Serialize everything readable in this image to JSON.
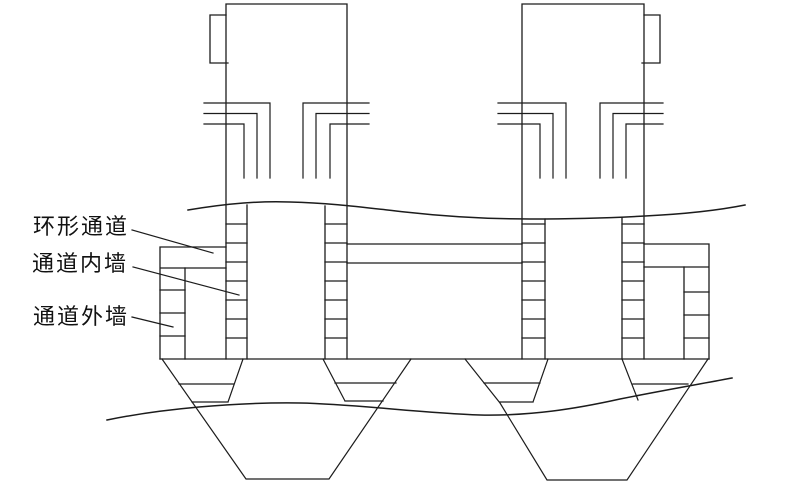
{
  "diagram": {
    "kind": "engineering-cross-section",
    "colors": {
      "background": "#ffffff",
      "line": "#1c1c1c",
      "text": "#111111"
    }
  },
  "labels": [
    {
      "text": "环形通道"
    },
    {
      "text": "通道内墙"
    },
    {
      "text": "通道外墙"
    }
  ]
}
